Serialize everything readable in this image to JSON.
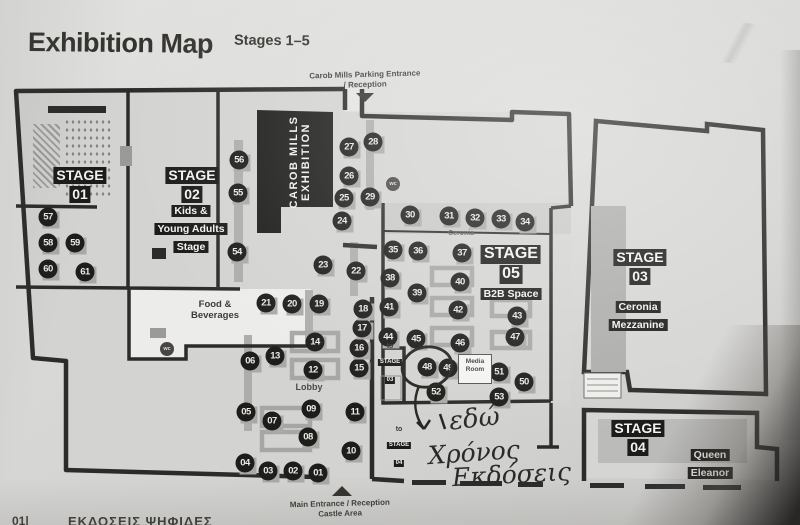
{
  "page": {
    "title": "Exhibition Map",
    "subtitle": "Stages 1–5",
    "footer_page": "01|",
    "footer_text": "ΕΚΔΟΣΕΙΣ ΨΗΦΙΔΕΣ"
  },
  "entrances": {
    "top_line1": "Carob Mills Parking Entrance",
    "top_line2": "/ Reception",
    "bottom_line1": "Main Entrance / Reception",
    "bottom_line2": "Castle Area"
  },
  "stages": {
    "stage01": {
      "line1": "STAGE",
      "line2": "01"
    },
    "stage02": {
      "line1": "STAGE",
      "line2": "02",
      "sub1": "Kids &",
      "sub2": "Young Adults",
      "sub3": "Stage"
    },
    "stage03": {
      "line1": "STAGE",
      "line2": "03",
      "sub1": "Ceronia",
      "sub2": "Mezzanine"
    },
    "stage04": {
      "line1": "STAGE",
      "line2": "04",
      "sub1": "Queen",
      "sub2": "Eleanor"
    },
    "stage05": {
      "line1": "STAGE",
      "line2": "05",
      "sub1": "B2B Space"
    }
  },
  "areas": {
    "carob_mills_line1": "CAROB MILLS",
    "carob_mills_line2": "EXHIBITION",
    "food_line1": "Food &",
    "food_line2": "Beverages",
    "lobby": "Lobby",
    "ceronia": "Ceronia",
    "media_line1": "Media",
    "media_line2": "Room",
    "wc": "wc",
    "to": "to",
    "to_stage03_line1": "STAGE",
    "to_stage03_line2": "03",
    "to_stage04_line1": "STAGE",
    "to_stage04_line2": "04"
  },
  "annotation": {
    "line1": "εδώ",
    "line2": "Χρόνος",
    "line3": "Εκδόσεις",
    "target_booth": "48"
  },
  "wc_markers": [
    {
      "x": 167,
      "y": 349
    },
    {
      "x": 393,
      "y": 184
    }
  ],
  "booths": [
    {
      "n": "01",
      "x": 318,
      "y": 473
    },
    {
      "n": "02",
      "x": 293,
      "y": 471
    },
    {
      "n": "03",
      "x": 268,
      "y": 471
    },
    {
      "n": "04",
      "x": 245,
      "y": 463
    },
    {
      "n": "05",
      "x": 246,
      "y": 412
    },
    {
      "n": "06",
      "x": 250,
      "y": 361
    },
    {
      "n": "07",
      "x": 272,
      "y": 421
    },
    {
      "n": "08",
      "x": 308,
      "y": 437
    },
    {
      "n": "09",
      "x": 311,
      "y": 409
    },
    {
      "n": "10",
      "x": 351,
      "y": 451
    },
    {
      "n": "11",
      "x": 355,
      "y": 412
    },
    {
      "n": "12",
      "x": 313,
      "y": 370
    },
    {
      "n": "13",
      "x": 275,
      "y": 356
    },
    {
      "n": "14",
      "x": 315,
      "y": 342
    },
    {
      "n": "15",
      "x": 359,
      "y": 368
    },
    {
      "n": "16",
      "x": 359,
      "y": 348
    },
    {
      "n": "17",
      "x": 362,
      "y": 328
    },
    {
      "n": "18",
      "x": 363,
      "y": 309
    },
    {
      "n": "19",
      "x": 319,
      "y": 304
    },
    {
      "n": "20",
      "x": 292,
      "y": 304
    },
    {
      "n": "21",
      "x": 266,
      "y": 303
    },
    {
      "n": "22",
      "x": 356,
      "y": 271
    },
    {
      "n": "23",
      "x": 323,
      "y": 265
    },
    {
      "n": "24",
      "x": 342,
      "y": 221
    },
    {
      "n": "25",
      "x": 344,
      "y": 198
    },
    {
      "n": "26",
      "x": 349,
      "y": 176
    },
    {
      "n": "27",
      "x": 349,
      "y": 147
    },
    {
      "n": "28",
      "x": 373,
      "y": 142
    },
    {
      "n": "29",
      "x": 370,
      "y": 197
    },
    {
      "n": "30",
      "x": 410,
      "y": 215
    },
    {
      "n": "31",
      "x": 449,
      "y": 216
    },
    {
      "n": "32",
      "x": 475,
      "y": 218
    },
    {
      "n": "33",
      "x": 501,
      "y": 219
    },
    {
      "n": "34",
      "x": 525,
      "y": 222
    },
    {
      "n": "35",
      "x": 393,
      "y": 250
    },
    {
      "n": "36",
      "x": 418,
      "y": 251
    },
    {
      "n": "37",
      "x": 462,
      "y": 253
    },
    {
      "n": "38",
      "x": 390,
      "y": 278
    },
    {
      "n": "39",
      "x": 417,
      "y": 293
    },
    {
      "n": "40",
      "x": 460,
      "y": 282
    },
    {
      "n": "41",
      "x": 389,
      "y": 307
    },
    {
      "n": "42",
      "x": 458,
      "y": 310
    },
    {
      "n": "43",
      "x": 517,
      "y": 316
    },
    {
      "n": "44",
      "x": 388,
      "y": 337
    },
    {
      "n": "45",
      "x": 416,
      "y": 339
    },
    {
      "n": "46",
      "x": 460,
      "y": 343
    },
    {
      "n": "47",
      "x": 515,
      "y": 337
    },
    {
      "n": "48",
      "x": 427,
      "y": 367
    },
    {
      "n": "49",
      "x": 448,
      "y": 368
    },
    {
      "n": "50",
      "x": 524,
      "y": 382
    },
    {
      "n": "51",
      "x": 499,
      "y": 372
    },
    {
      "n": "52",
      "x": 436,
      "y": 392
    },
    {
      "n": "53",
      "x": 499,
      "y": 397
    },
    {
      "n": "54",
      "x": 237,
      "y": 252
    },
    {
      "n": "55",
      "x": 238,
      "y": 193
    },
    {
      "n": "56",
      "x": 239,
      "y": 160
    },
    {
      "n": "57",
      "x": 48,
      "y": 217
    },
    {
      "n": "58",
      "x": 48,
      "y": 243
    },
    {
      "n": "59",
      "x": 75,
      "y": 243
    },
    {
      "n": "60",
      "x": 48,
      "y": 269
    },
    {
      "n": "61",
      "x": 85,
      "y": 272
    }
  ]
}
